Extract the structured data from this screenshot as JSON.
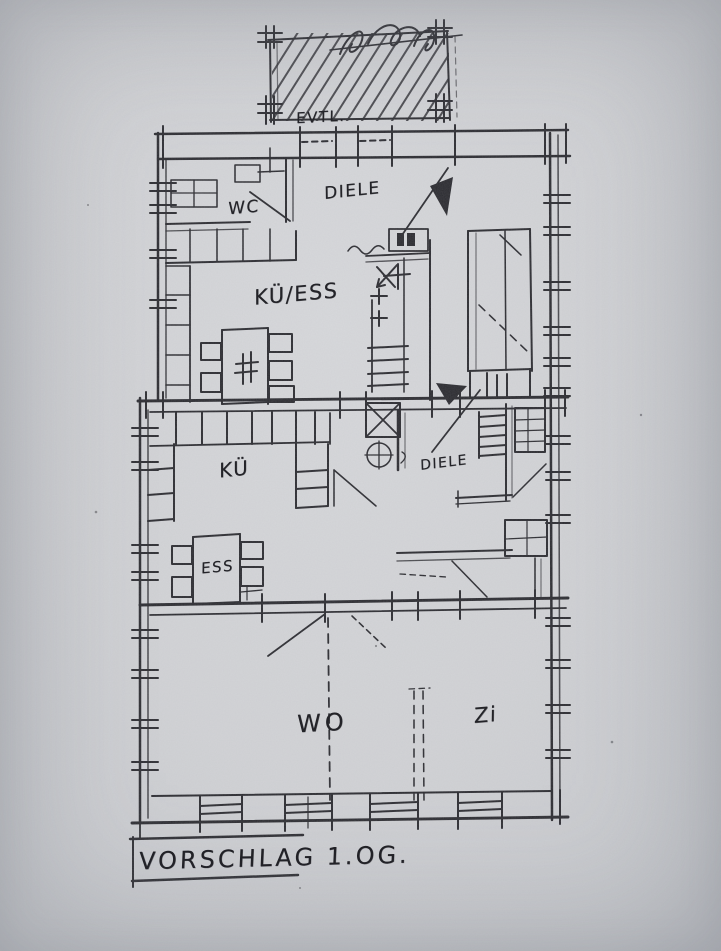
{
  "plan": {
    "title": "VORSCHLAG 1.OG.",
    "balcony_note": "EVTL.",
    "rooms": {
      "wc": "WC",
      "hall_upper": "DIELE",
      "kitchen_dining": "KÜ/ESS",
      "kitchen": "KÜ",
      "hall_middle": "DIELE",
      "dining": "ESS",
      "living": "WO",
      "room": "Zi"
    },
    "colors": {
      "paper": "#d2d3d6",
      "ink": "#2c2c31"
    }
  }
}
